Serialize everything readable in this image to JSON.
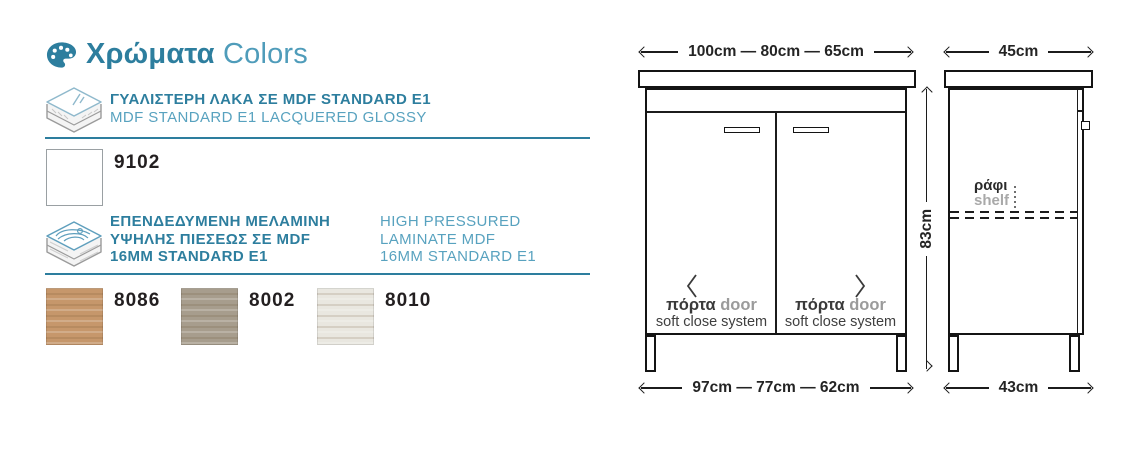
{
  "colors": {
    "accent_teal": "#2d7e9e",
    "accent_teal_light": "#58a2bf",
    "drawing_line": "#1c1c1c",
    "text_dark": "#231f20",
    "text_gray": "#9b9b9b"
  },
  "header": {
    "title_gr": "Χρώματα",
    "title_en": "Colors",
    "icon": "palette-icon"
  },
  "materials": [
    {
      "icon": "lacquer-stack-icon",
      "gr": "ΓΥΑΛΙΣΤΕΡΗ ΛΑΚΑ ΣΕ MDF STANDARD E1",
      "en": "MDF STANDARD E1 LACQUERED GLOSSY",
      "swatches": [
        {
          "code": "9102",
          "hex": "#ffffff"
        }
      ]
    },
    {
      "icon": "wood-stack-icon",
      "gr_lines": [
        "ΕΠΕΝΔΕΔΥΜΕΝΗ ΜΕΛΑΜΙΝΗ",
        "ΥΨΗΛΗΣ ΠΙΕΣΕΩΣ ΣΕ MDF",
        "16MM STANDARD E1"
      ],
      "en_lines": [
        "HIGH PRESSURED",
        "LAMINATE MDF",
        "16MM STANDARD E1"
      ],
      "swatches": [
        {
          "code": "8086",
          "hex": "#c6976b"
        },
        {
          "code": "8002",
          "hex": "#a79d8d"
        },
        {
          "code": "8010",
          "hex": "#e9e7e0"
        }
      ]
    }
  ],
  "front_view": {
    "dim_top": "100cm — 80cm — 65cm",
    "dim_bottom": "97cm — 77cm — 62cm",
    "dim_height": "83cm",
    "doors": [
      {
        "gr": "πόρτα",
        "en": "door",
        "sub": "soft close system",
        "chevron": "left-chevron-icon"
      },
      {
        "gr": "πόρτα",
        "en": "door",
        "sub": "soft close system",
        "chevron": "right-chevron-icon"
      }
    ]
  },
  "side_view": {
    "dim_top": "45cm",
    "dim_bottom": "43cm",
    "shelf_gr": "ράφι",
    "shelf_en": "shelf"
  }
}
